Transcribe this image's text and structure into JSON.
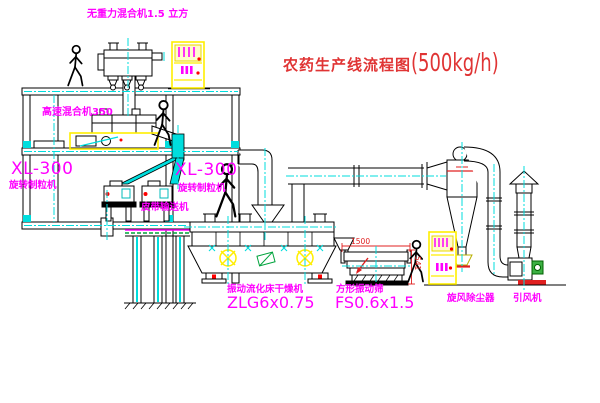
{
  "title": {
    "main": "农药生产线流程图",
    "capacity": "(500kg/h)"
  },
  "labels": {
    "gravity_mixer": "无重力混合机1.5 立方",
    "high_speed_mixer": "高速混合机350",
    "granulator_left": {
      "model": "XL-300",
      "name": "旋转制粒机"
    },
    "granulator_right": {
      "model": "XL-300",
      "name": "旋转制粒机"
    },
    "belt_conveyor": "皮带输送机",
    "dryer": {
      "name": "振动流化床干燥机",
      "model": "ZLG6x0.75"
    },
    "screen": {
      "name": "方形振动筛",
      "model": "FS0.6x1.5"
    },
    "cyclone": "旋风除尘器",
    "fan": "引风机"
  },
  "dimensions": {
    "screen_length": "1500",
    "screen_height": "541"
  },
  "colors": {
    "label_magenta": "#ff00ff",
    "title_red": "#e03434",
    "line_black": "#000000",
    "centerline_cyan": "#00dddd",
    "highlight_yellow": "#ffee00",
    "accent_red": "#ff0000",
    "accent_green": "#00a33c"
  }
}
